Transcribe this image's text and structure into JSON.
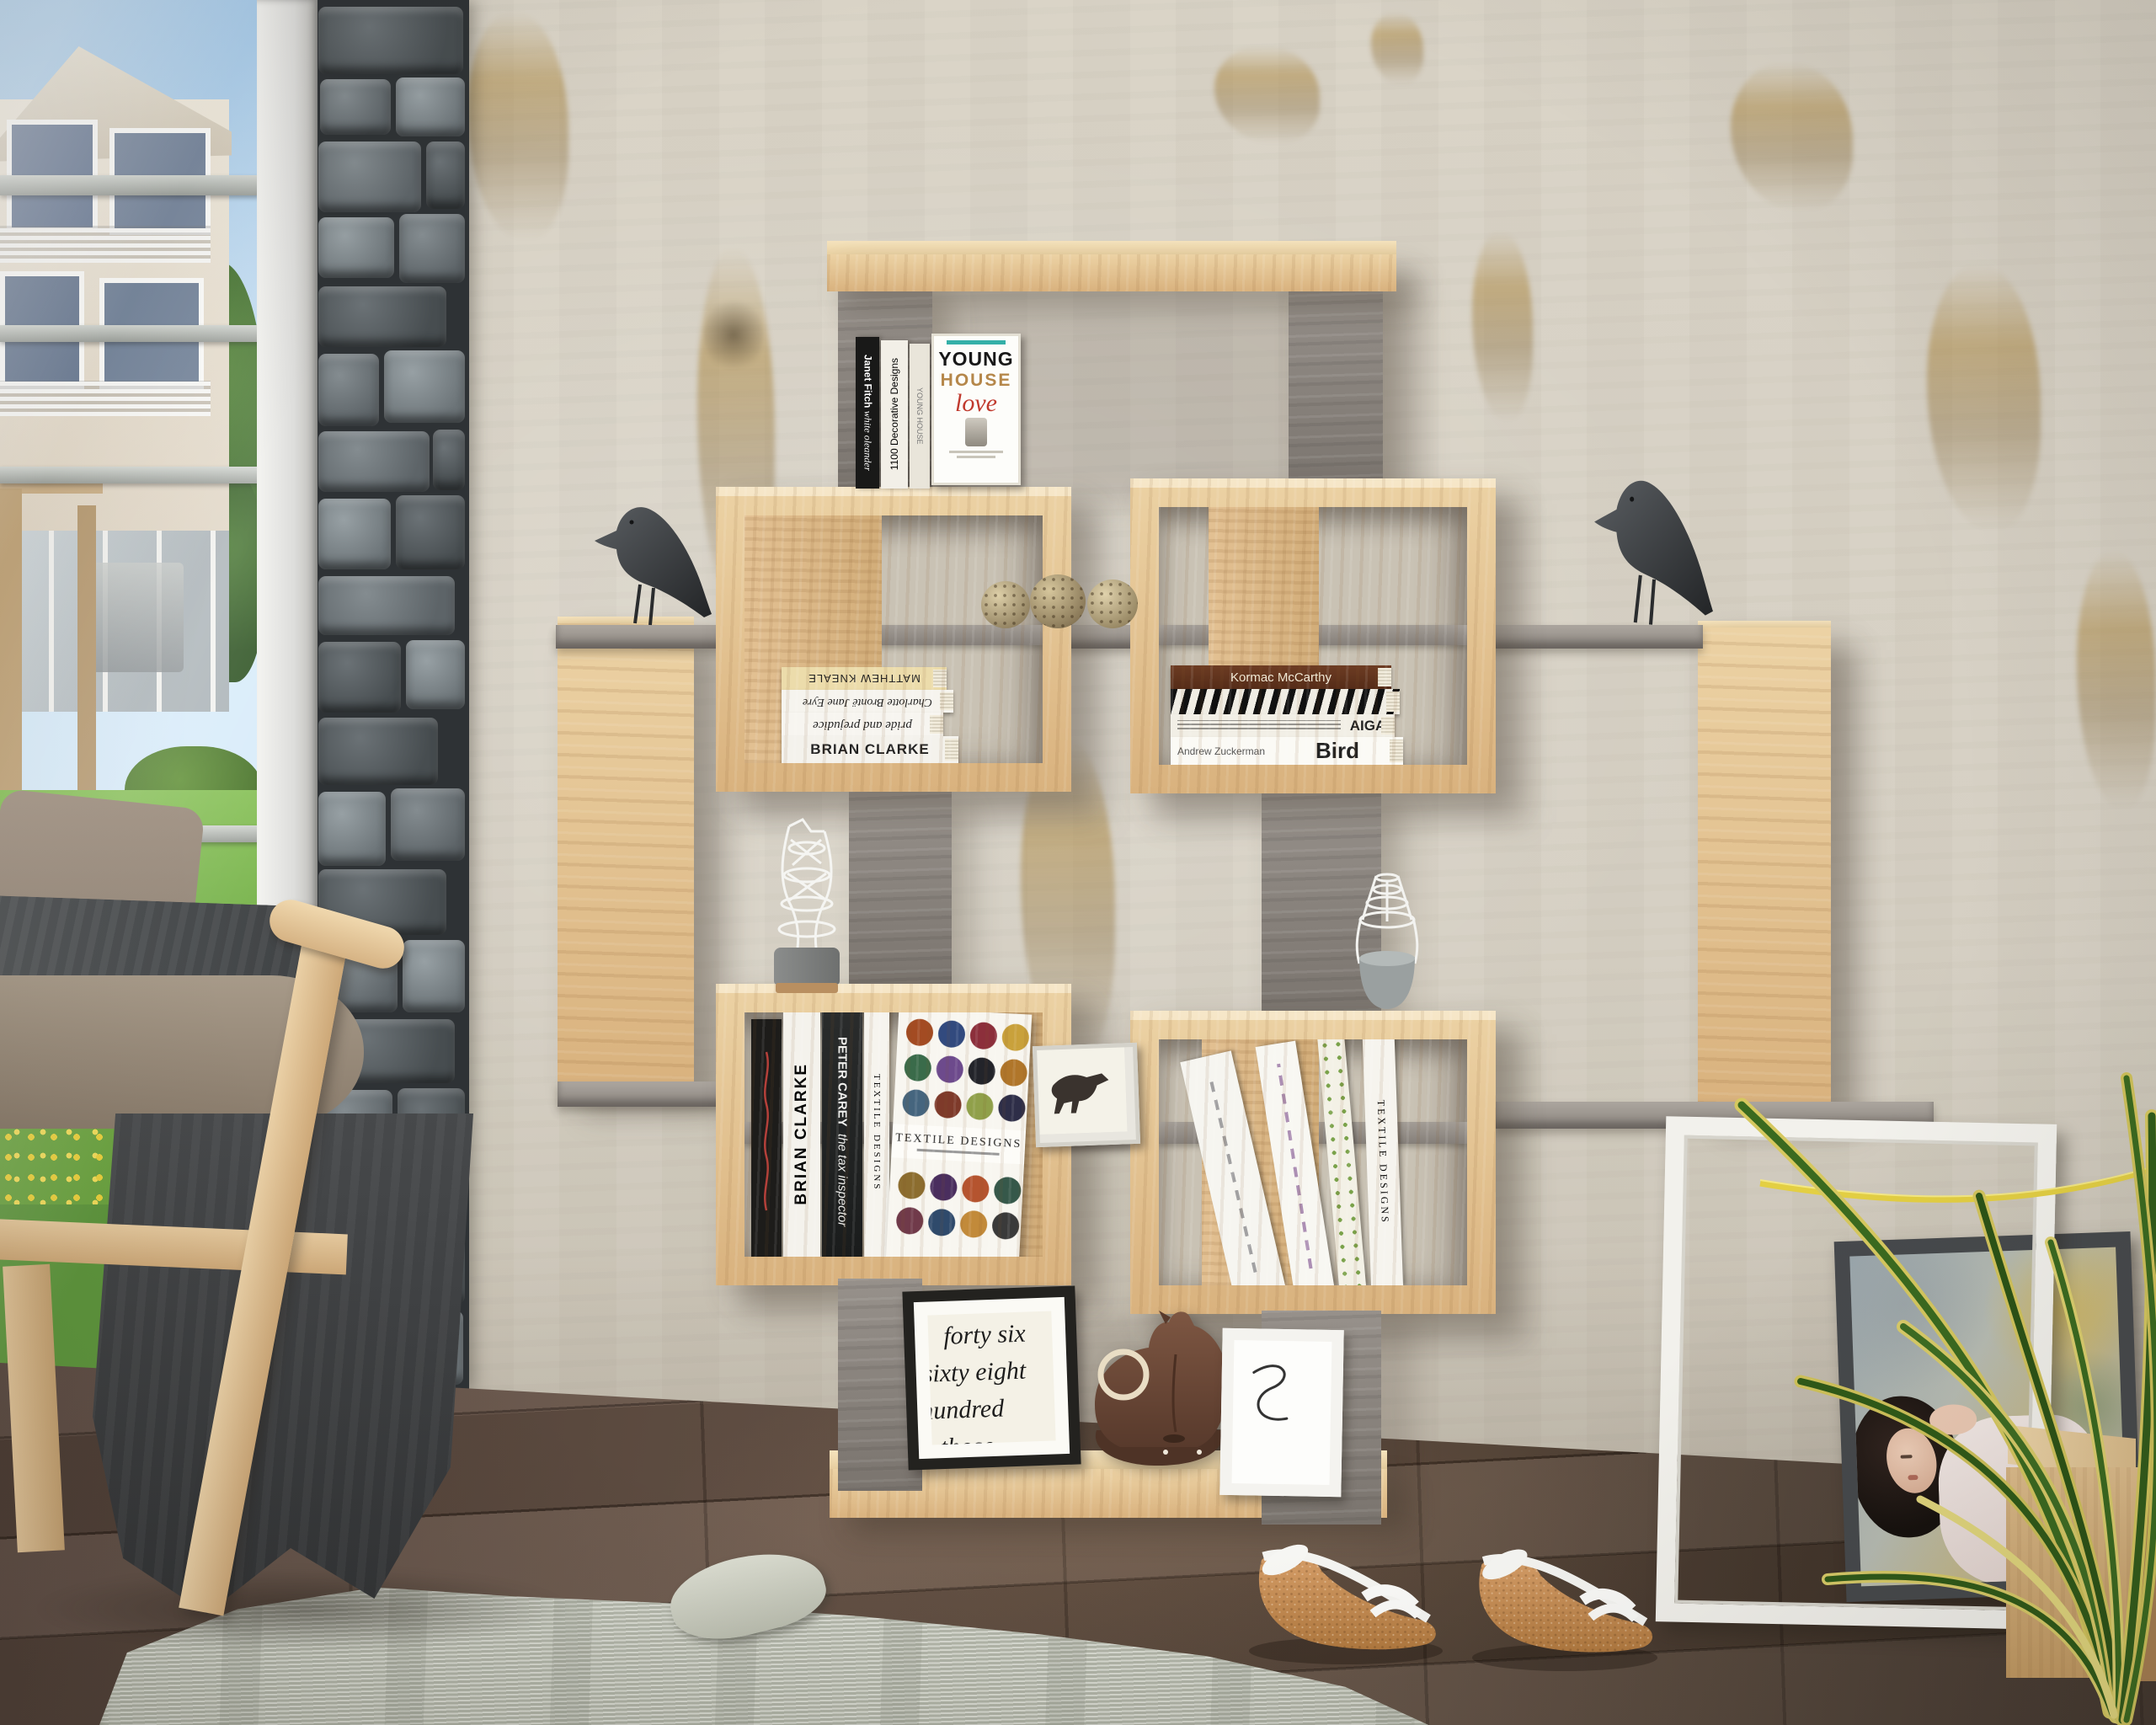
{
  "palette": {
    "wall": "#d6d0c4",
    "oak": "#ddb886",
    "oak_light": "#f0dcb0",
    "panel_grey": "#8e8881",
    "floor": "#5a483b",
    "rug": "#c9ccc0",
    "sky": "#a9cdec",
    "grass": "#74b544",
    "bird_black": "#3c3f41",
    "horse_brown": "#6e4a38",
    "cork": "#c6905f",
    "plant_green": "#3a6a1f",
    "plant_yellow": "#d6c85f",
    "love_red": "#c03a2e",
    "house_tan": "#b5874a"
  },
  "books": {
    "top_shelf": {
      "spine1_author": "Janet Fitch",
      "spine1_title": "white oleander",
      "spine2_title": "1100 Decorative Designs",
      "spine3_title": "YOUNG HOUSE",
      "cover_word1": "YOUNG",
      "cover_word2": "HOUSE",
      "cover_word3": "love"
    },
    "upper_left_stack": [
      "MATTHEW KNEALE",
      "Charlotte Brontë  Jane Eyre",
      "pride and prejudice",
      "BRIAN CLARKE"
    ],
    "upper_right_stack": {
      "mccarthy": "Kormac McCarthy",
      "aiga": "AIGA",
      "bird_author": "Andrew Zuckerman",
      "bird_title": "Bird"
    },
    "lower_left": {
      "clarke": "BRIAN CLARKE",
      "carey_author": "PETER CAREY",
      "carey_title": "the tax inspector",
      "textile_spine": "TEXTILE DESIGNS",
      "textile_cover_title": "TEXTILE DESIGNS"
    },
    "lower_right": {
      "textile_spine": "TEXTILE DESIGNS"
    }
  },
  "frames": {
    "handwriting_lines": [
      "forty six",
      "sixty eight",
      "hundred",
      "those"
    ]
  },
  "objects": {
    "left_bird": "black-bird-figurine",
    "right_bird": "black-bird-figurine",
    "pinecones": "three-pinecones",
    "wire_vase_left": "white-wire-vase",
    "wire_vase_right": "white-wire-bottle-vase",
    "horse_picture": "framed-horse-print",
    "rocking_horse": "leather-rocking-horse",
    "squiggle_frame": "framed-squiggle-drawing",
    "empty_frame": "leaning-empty-white-frame",
    "portrait": "leaning-vintage-woman-portrait",
    "plant": "variegated-grass-plant",
    "stool": "small-wooden-stool",
    "wedge_sandals": "white-cork-wedge-sandals",
    "armchair": "grey-fabric-armchair-with-wood-frame",
    "rug": "light-grey-knit-rug",
    "window": "window-with-garden-view",
    "pillar": "stacked-stone-pillar",
    "bookshelf": "oak-and-grey-geometric-bookcase"
  }
}
